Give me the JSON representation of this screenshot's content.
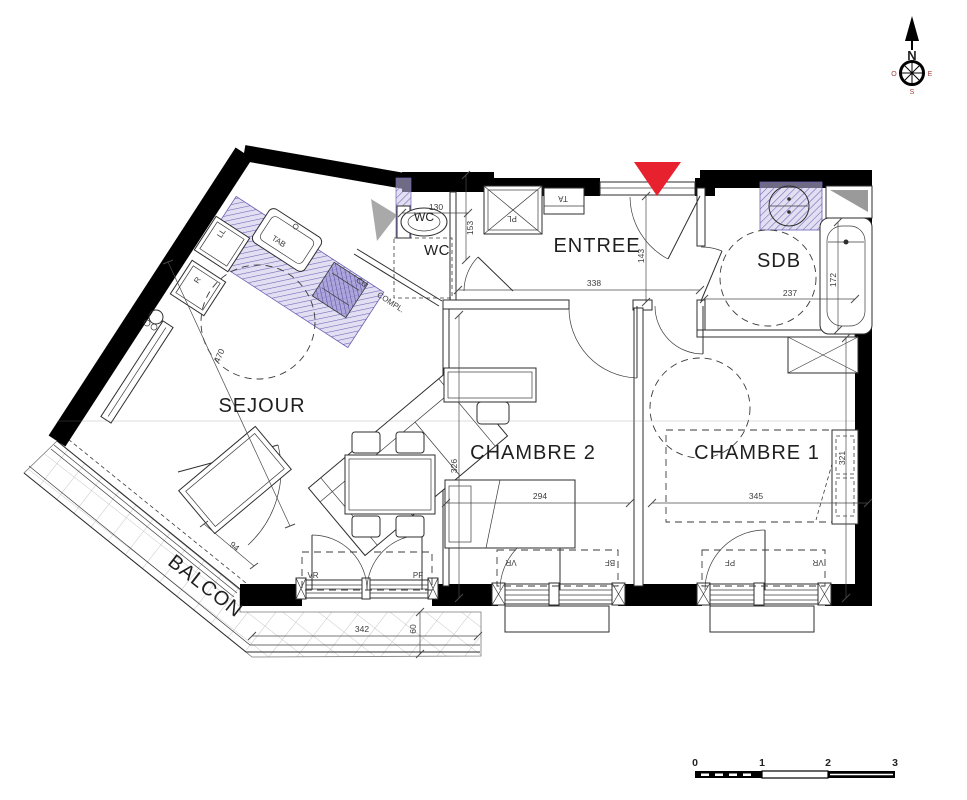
{
  "title": "Plan d'appartement 3 pièces",
  "rooms": {
    "sejour": "SEJOUR",
    "entree": "ENTREE",
    "sdb": "SDB",
    "wc": "WC",
    "wc_small": "WC",
    "chambre2": "CHAMBRE 2",
    "chambre1": "CHAMBRE 1",
    "balcon": "BALCON"
  },
  "dims": {
    "d130": "130",
    "d153": "153",
    "d338": "338",
    "d143": "143",
    "d237": "237",
    "d172": "172",
    "d470": "470",
    "d326": "326",
    "d294": "294",
    "d345": "345",
    "d321": "321",
    "d342": "342",
    "d60": "60",
    "d94": "94"
  },
  "tags": {
    "ta": "TA",
    "pl": "PL",
    "ll": "LL",
    "r": "R",
    "tab": "TAB",
    "cu": "CU",
    "compl": "COMPL.",
    "vr": "VR",
    "pf": "PF",
    "bf": "BF"
  },
  "compass": {
    "n": "N",
    "o": "O",
    "e": "E",
    "s": "S"
  },
  "scalebar": {
    "t0": "0",
    "t1": "1",
    "t2": "2",
    "t3": "3"
  },
  "colors": {
    "wall": "#000000",
    "red_marker": "#e8212e",
    "purple_line": "#6c61b5",
    "gray_fill": "#9a9a9a"
  }
}
